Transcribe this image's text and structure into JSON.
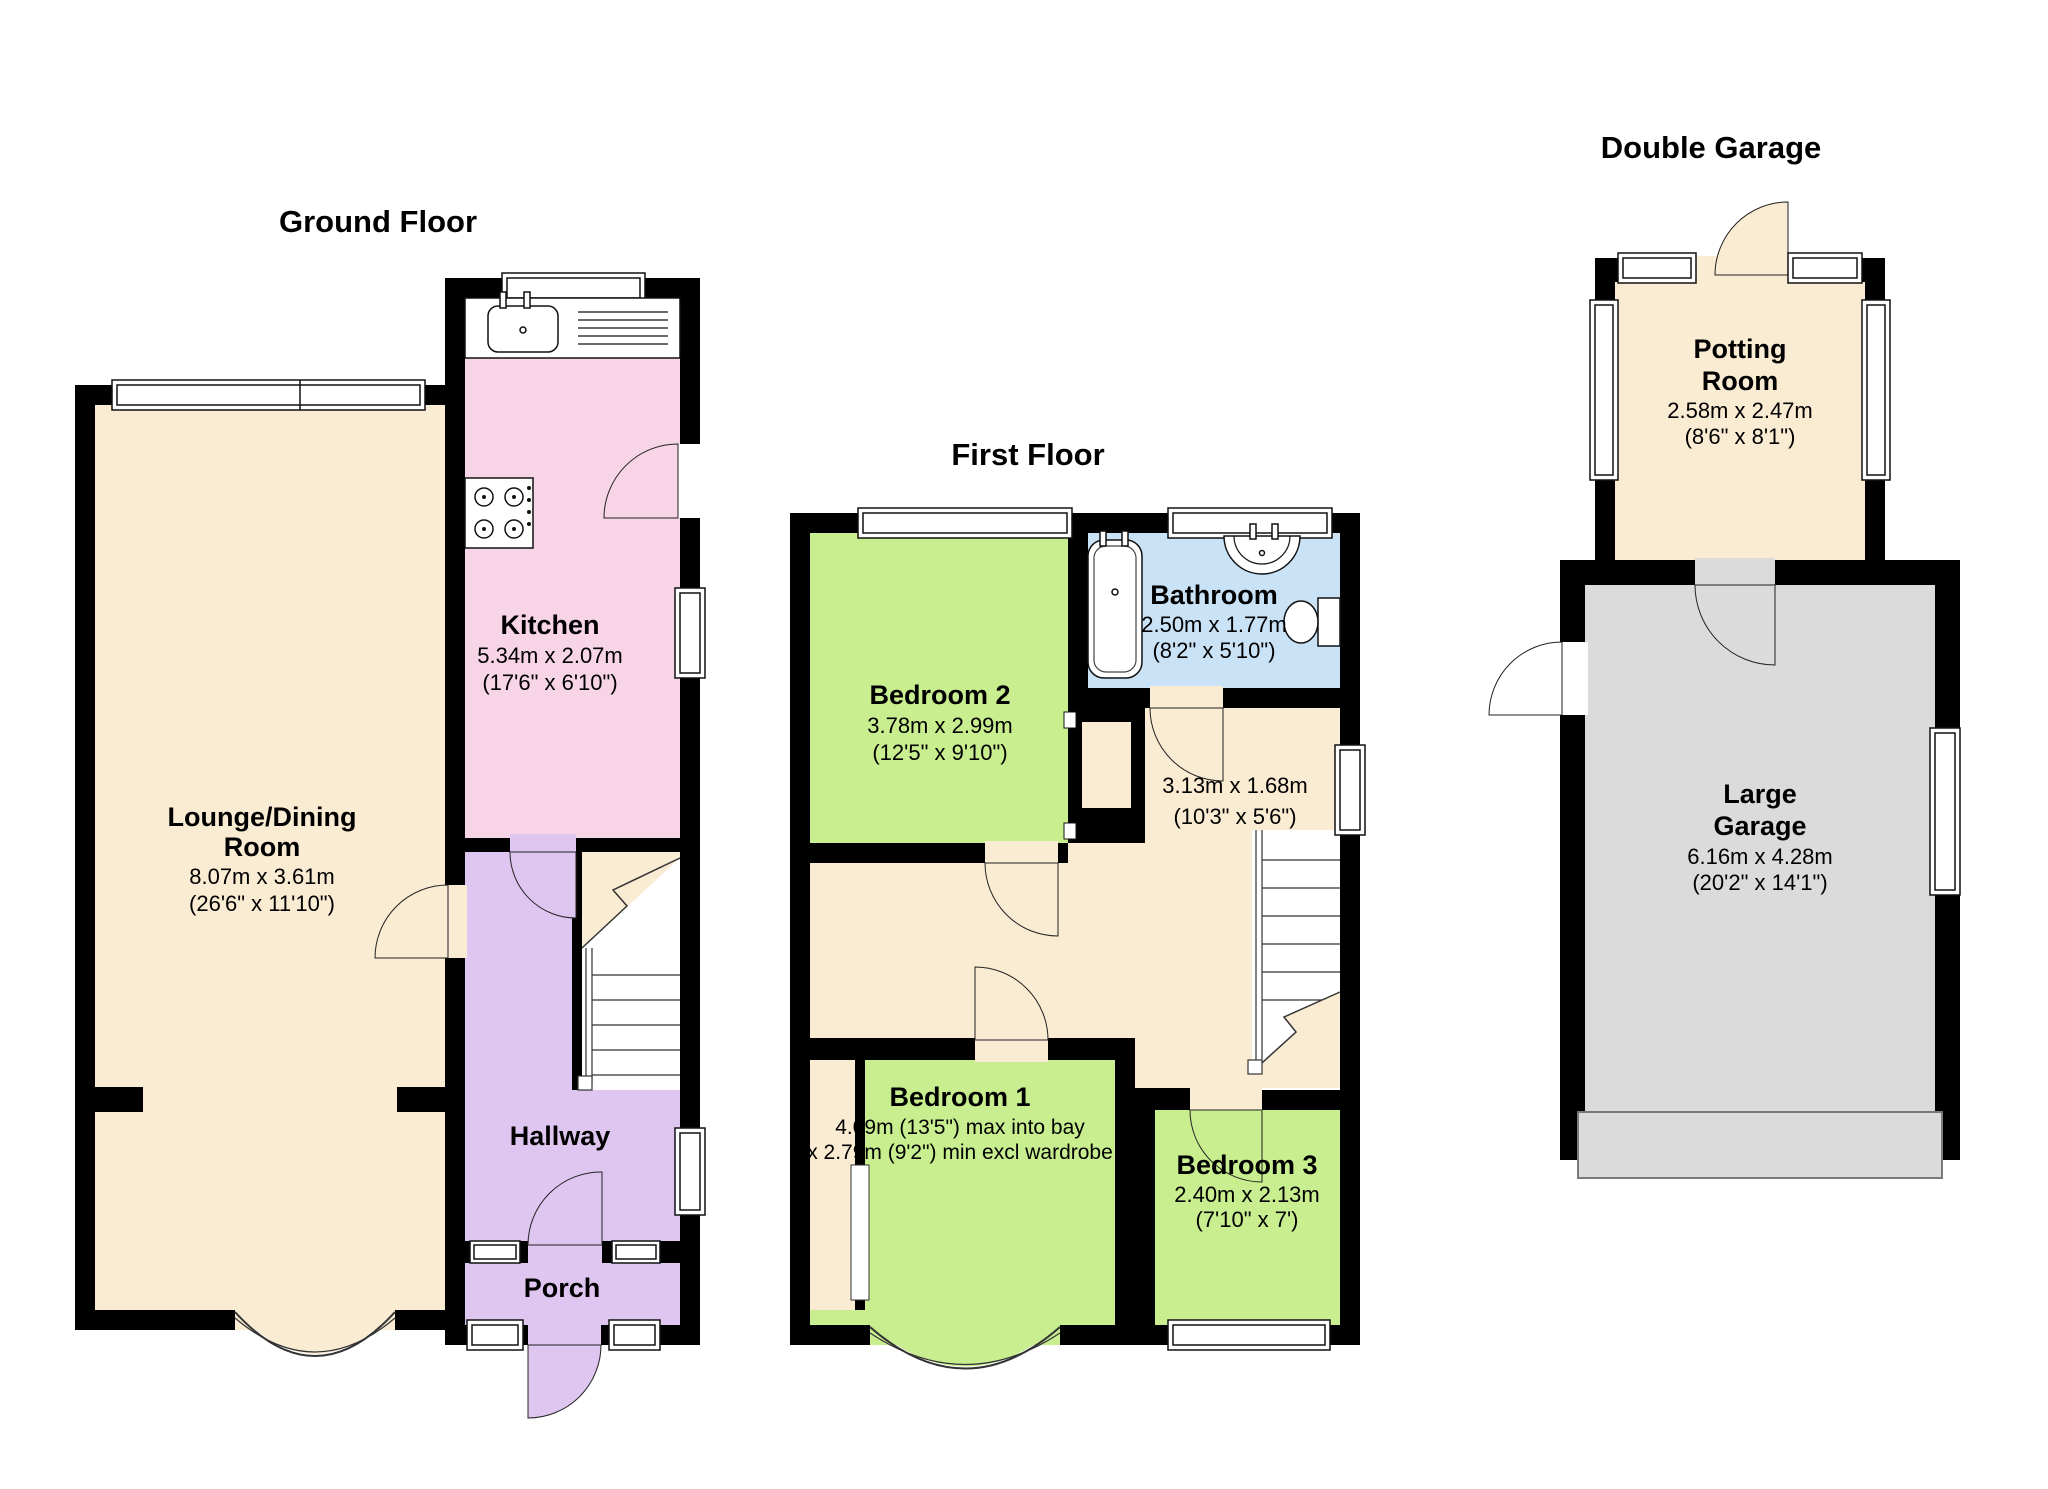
{
  "colors": {
    "wall": "#000000",
    "cream": "#FAEBD3",
    "pink": "#F7D4E6",
    "purple": "#DFC6F0",
    "green": "#C8EE8F",
    "blue": "#C9E2F6",
    "garage_gray": "#DBDBDB",
    "fixture_white": "#FFFFFF"
  },
  "ground_floor": {
    "title": "Ground Floor",
    "kitchen": {
      "name": "Kitchen",
      "dims_m": "5.34m x 2.07m",
      "dims_ft": "(17'6\" x 6'10\")"
    },
    "lounge": {
      "name_line1": "Lounge/Dining",
      "name_line2": "Room",
      "dims_m": "8.07m x 3.61m",
      "dims_ft": "(26'6\" x 11'10\")"
    },
    "hallway": {
      "name": "Hallway"
    },
    "porch": {
      "name": "Porch"
    }
  },
  "first_floor": {
    "title": "First Floor",
    "bedroom2": {
      "name": "Bedroom 2",
      "dims_m": "3.78m x 2.99m",
      "dims_ft": "(12'5\" x 9'10\")"
    },
    "bathroom": {
      "name": "Bathroom",
      "dims_m": "2.50m x 1.77m",
      "dims_ft": "(8'2\" x 5'10\")"
    },
    "landing": {
      "dims_m": "3.13m x 1.68m",
      "dims_ft": "(10'3\" x 5'6\")"
    },
    "bedroom1": {
      "name": "Bedroom 1",
      "dims_line1": "4.09m (13'5\") max into bay",
      "dims_line2": "x 2.79m (9'2\") min excl wardrobe"
    },
    "bedroom3": {
      "name": "Bedroom 3",
      "dims_m": "2.40m x 2.13m",
      "dims_ft": "(7'10\" x 7')"
    }
  },
  "garage_floor": {
    "title": "Double Garage",
    "potting_room": {
      "name_line1": "Potting",
      "name_line2": "Room",
      "dims_m": "2.58m x 2.47m",
      "dims_ft": "(8'6\" x 8'1\")"
    },
    "large_garage": {
      "name_line1": "Large",
      "name_line2": "Garage",
      "dims_m": "6.16m x 4.28m",
      "dims_ft": "(20'2\" x 14'1\")"
    }
  }
}
